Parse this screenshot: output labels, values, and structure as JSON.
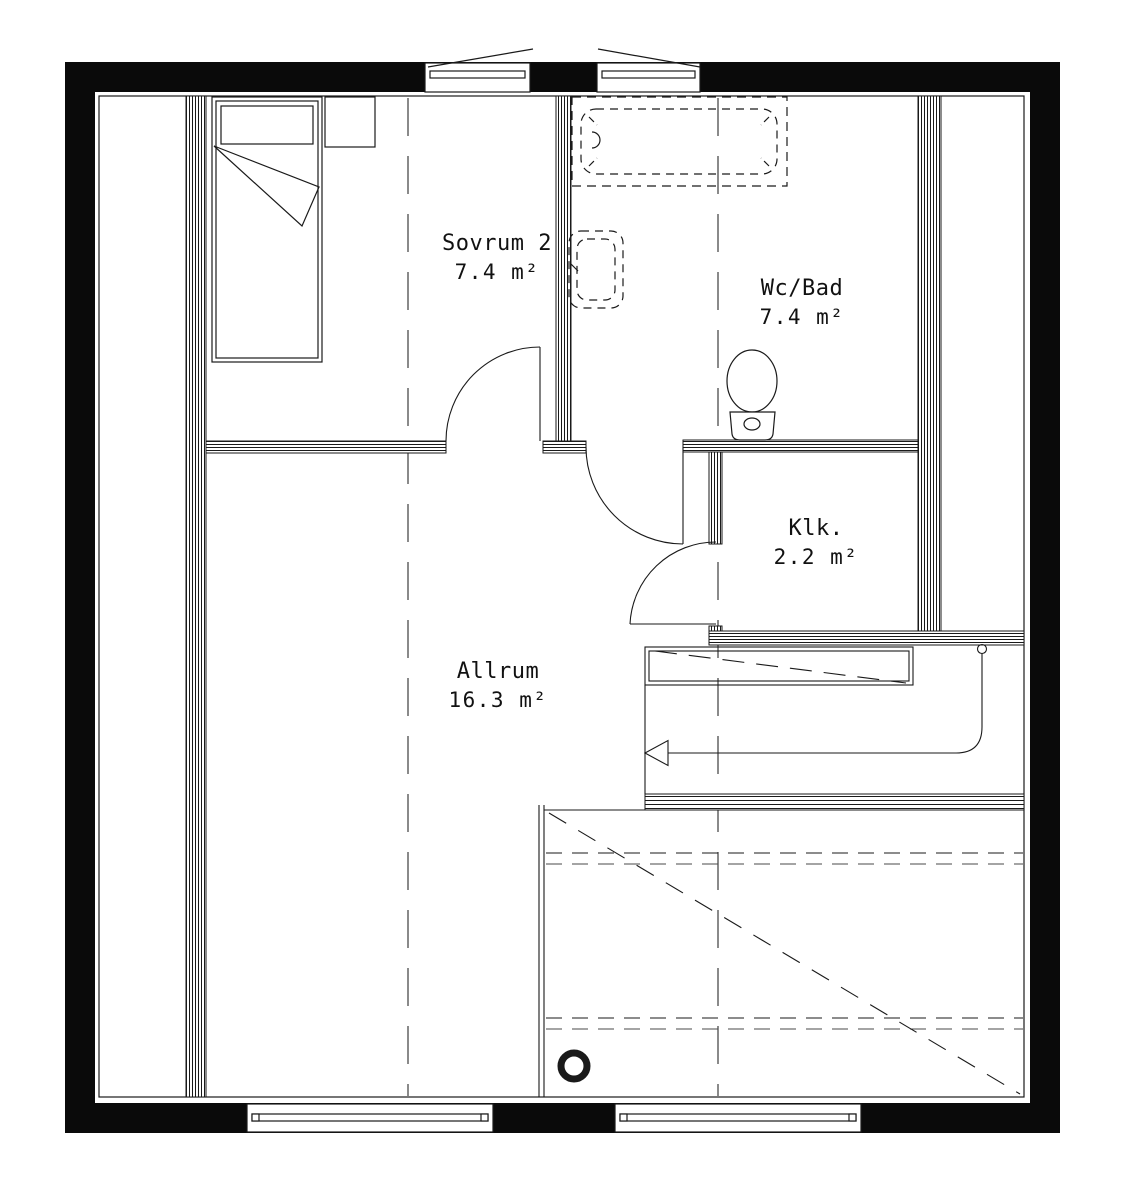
{
  "drawing_type": "floor-plan",
  "rooms": [
    {
      "id": "sovrum2",
      "name": "Sovrum 2",
      "area": "7.4 m²"
    },
    {
      "id": "wcbad",
      "name": "Wc/Bad",
      "area": "7.4 m²"
    },
    {
      "id": "klk",
      "name": "Klk.",
      "area": "2.2 m²"
    },
    {
      "id": "allrum",
      "name": "Allrum",
      "area": "16.3 m²"
    }
  ],
  "fixtures": [
    "bed",
    "nightstand",
    "bathtub",
    "washbasin",
    "toilet",
    "stair-with-down-arrow",
    "chimney-pipe",
    "attic-storage"
  ],
  "windows": {
    "top_wall": 2,
    "bottom_wall": 2
  },
  "doors": [
    "sovrum2-door",
    "wcbad-door",
    "klk-door"
  ],
  "colors": {
    "line": "#1a1a1a",
    "wall_fill": "#0a0a0a",
    "background": "#ffffff"
  }
}
